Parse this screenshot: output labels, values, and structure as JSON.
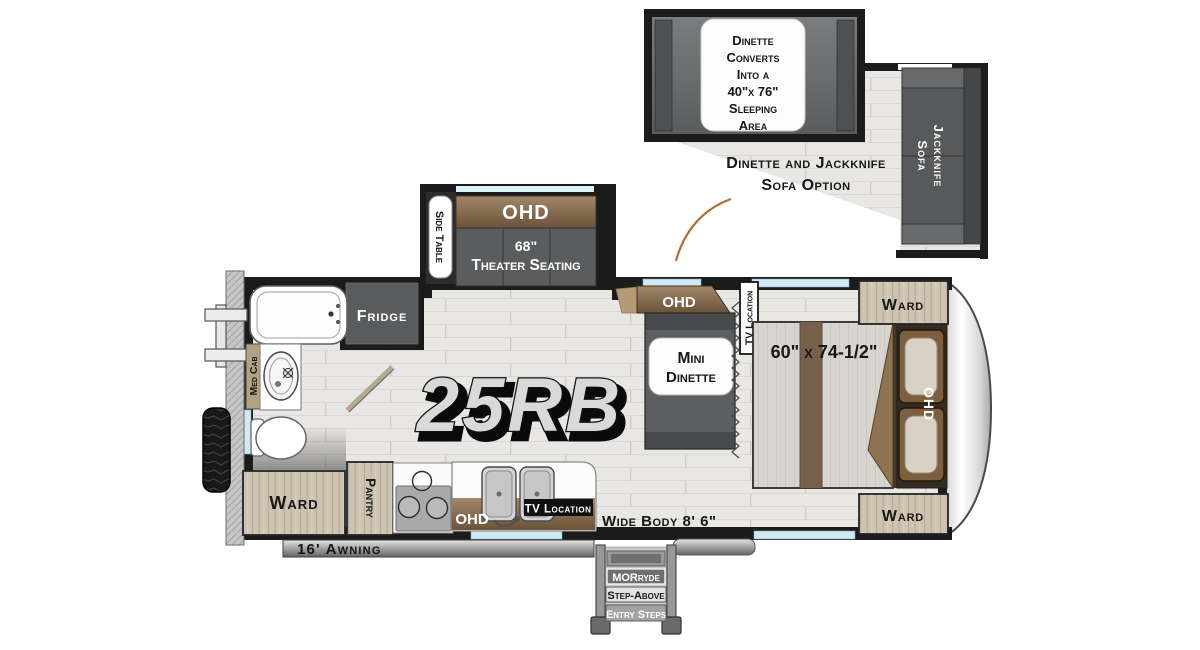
{
  "model_name": "25RB",
  "option_inset": {
    "note_lines": [
      "Dinette",
      "Converts",
      "Into a",
      "40\"x 76\"",
      "Sleeping",
      "Area"
    ],
    "caption_lines": [
      "Dinette and Jackknife",
      "Sofa Option"
    ],
    "sofa_lines": [
      "Jackknife",
      "Sofa"
    ]
  },
  "labels": {
    "ohd": "OHD",
    "side_table": "Side Table",
    "theater_size": "68\"",
    "theater_seating": "Theater Seating",
    "fridge": "Fridge",
    "med_cab": "Med Cab",
    "ward": "Ward",
    "pantry": "Pantry",
    "mini_line1": "Mini",
    "mini_line2": "Dinette",
    "tv_location": "TV Location",
    "bed_size": "60\" x 74-1/2\"",
    "wide_body": "Wide Body 8' 6\"",
    "awning": "16' Awning"
  },
  "entry_steps": {
    "line1": "MORryde",
    "line2": "Step-Above",
    "line3": "Entry Steps"
  },
  "colors": {
    "cabinet_brown": "#8a7156",
    "furniture_gray": "#595b5d",
    "window_blue": "#cfeaf5",
    "wood_tan": "#cdc3b1",
    "wall_black": "#1b1b1b"
  }
}
